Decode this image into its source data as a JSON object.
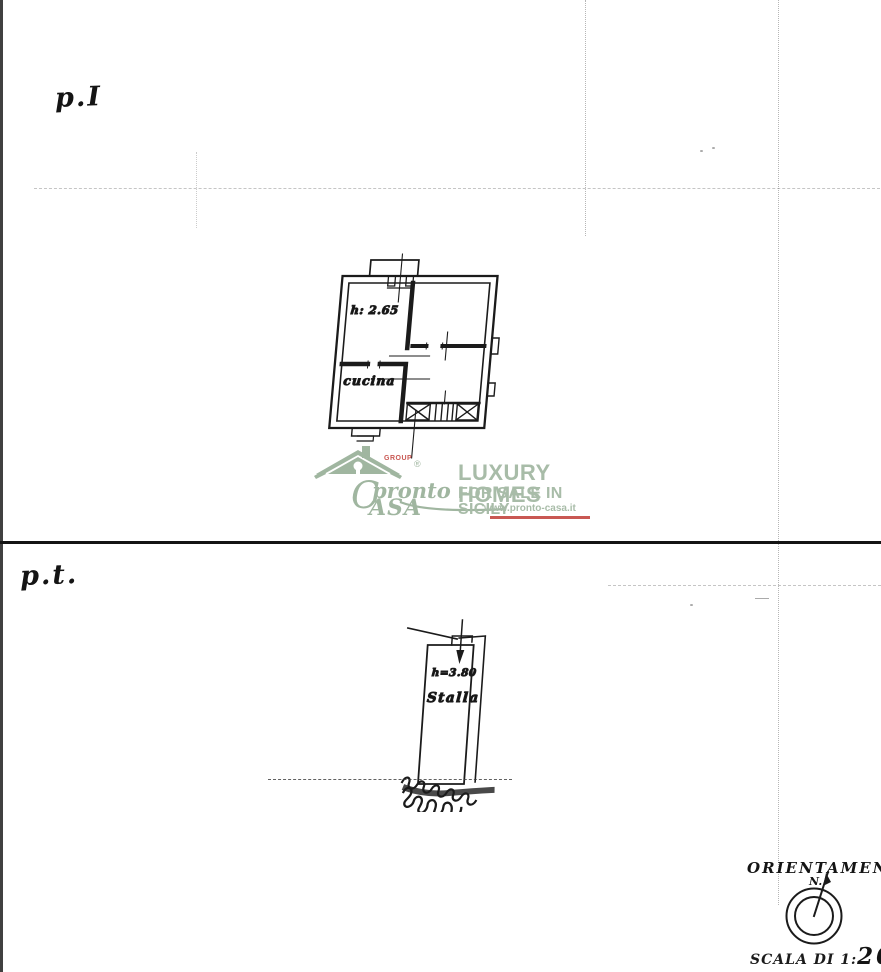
{
  "document": {
    "upper_floor_label": "p.I",
    "lower_floor_label": "p.t.",
    "upper_plan": {
      "height_label": "h: 2.65",
      "room_label": "cucina"
    },
    "lower_plan": {
      "height_label": "h=3.80",
      "room_label": "Stalla"
    },
    "orientation": {
      "title": "ORIENTAMENTO",
      "north_label": "N."
    },
    "scale": {
      "prefix": "SCALA DI 1:",
      "value": "200"
    }
  },
  "watermark": {
    "group_label": "GROUP",
    "registered_mark": "®",
    "brand_initial": "C",
    "brand_top": "pronto",
    "brand_bottom": "ASA",
    "tagline_line1": "LUXURY HOMES",
    "tagline_line2": "FOR SALE IN SICILY",
    "website": "www.pronto-casa.it",
    "colors": {
      "green": "#94ac94",
      "red": "#c2423c"
    }
  }
}
